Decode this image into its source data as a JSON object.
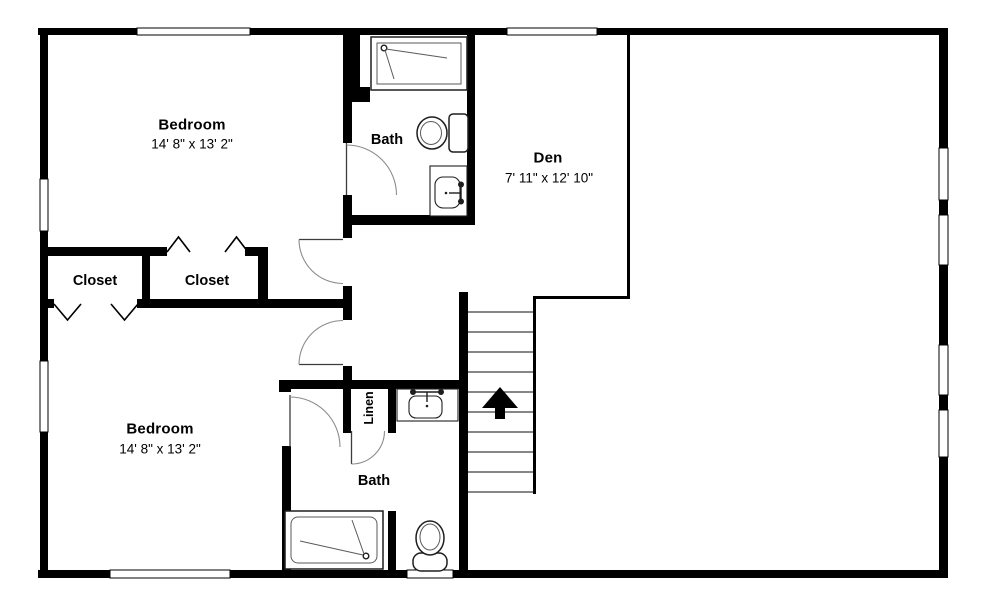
{
  "colors": {
    "wall": "#000000",
    "background": "#ffffff",
    "door_line": "#8c8c8c",
    "fixture_line": "#1e1e1e",
    "fixture_detail": "#5a5a5a",
    "tread_line": "#3d3d3d"
  },
  "rooms": {
    "bedroom_top": {
      "name": "Bedroom",
      "dims": "14' 8\" x 13' 2\""
    },
    "bath_top": {
      "name": "Bath"
    },
    "den": {
      "name": "Den",
      "dims": "7' 11\" x 12' 10\""
    },
    "closet_left": {
      "name": "Closet"
    },
    "closet_right": {
      "name": "Closet"
    },
    "bedroom_bottom": {
      "name": "Bedroom",
      "dims": "14' 8\" x 13' 2\""
    },
    "bath_bottom": {
      "name": "Bath"
    },
    "linen": {
      "name": "Linen"
    }
  }
}
